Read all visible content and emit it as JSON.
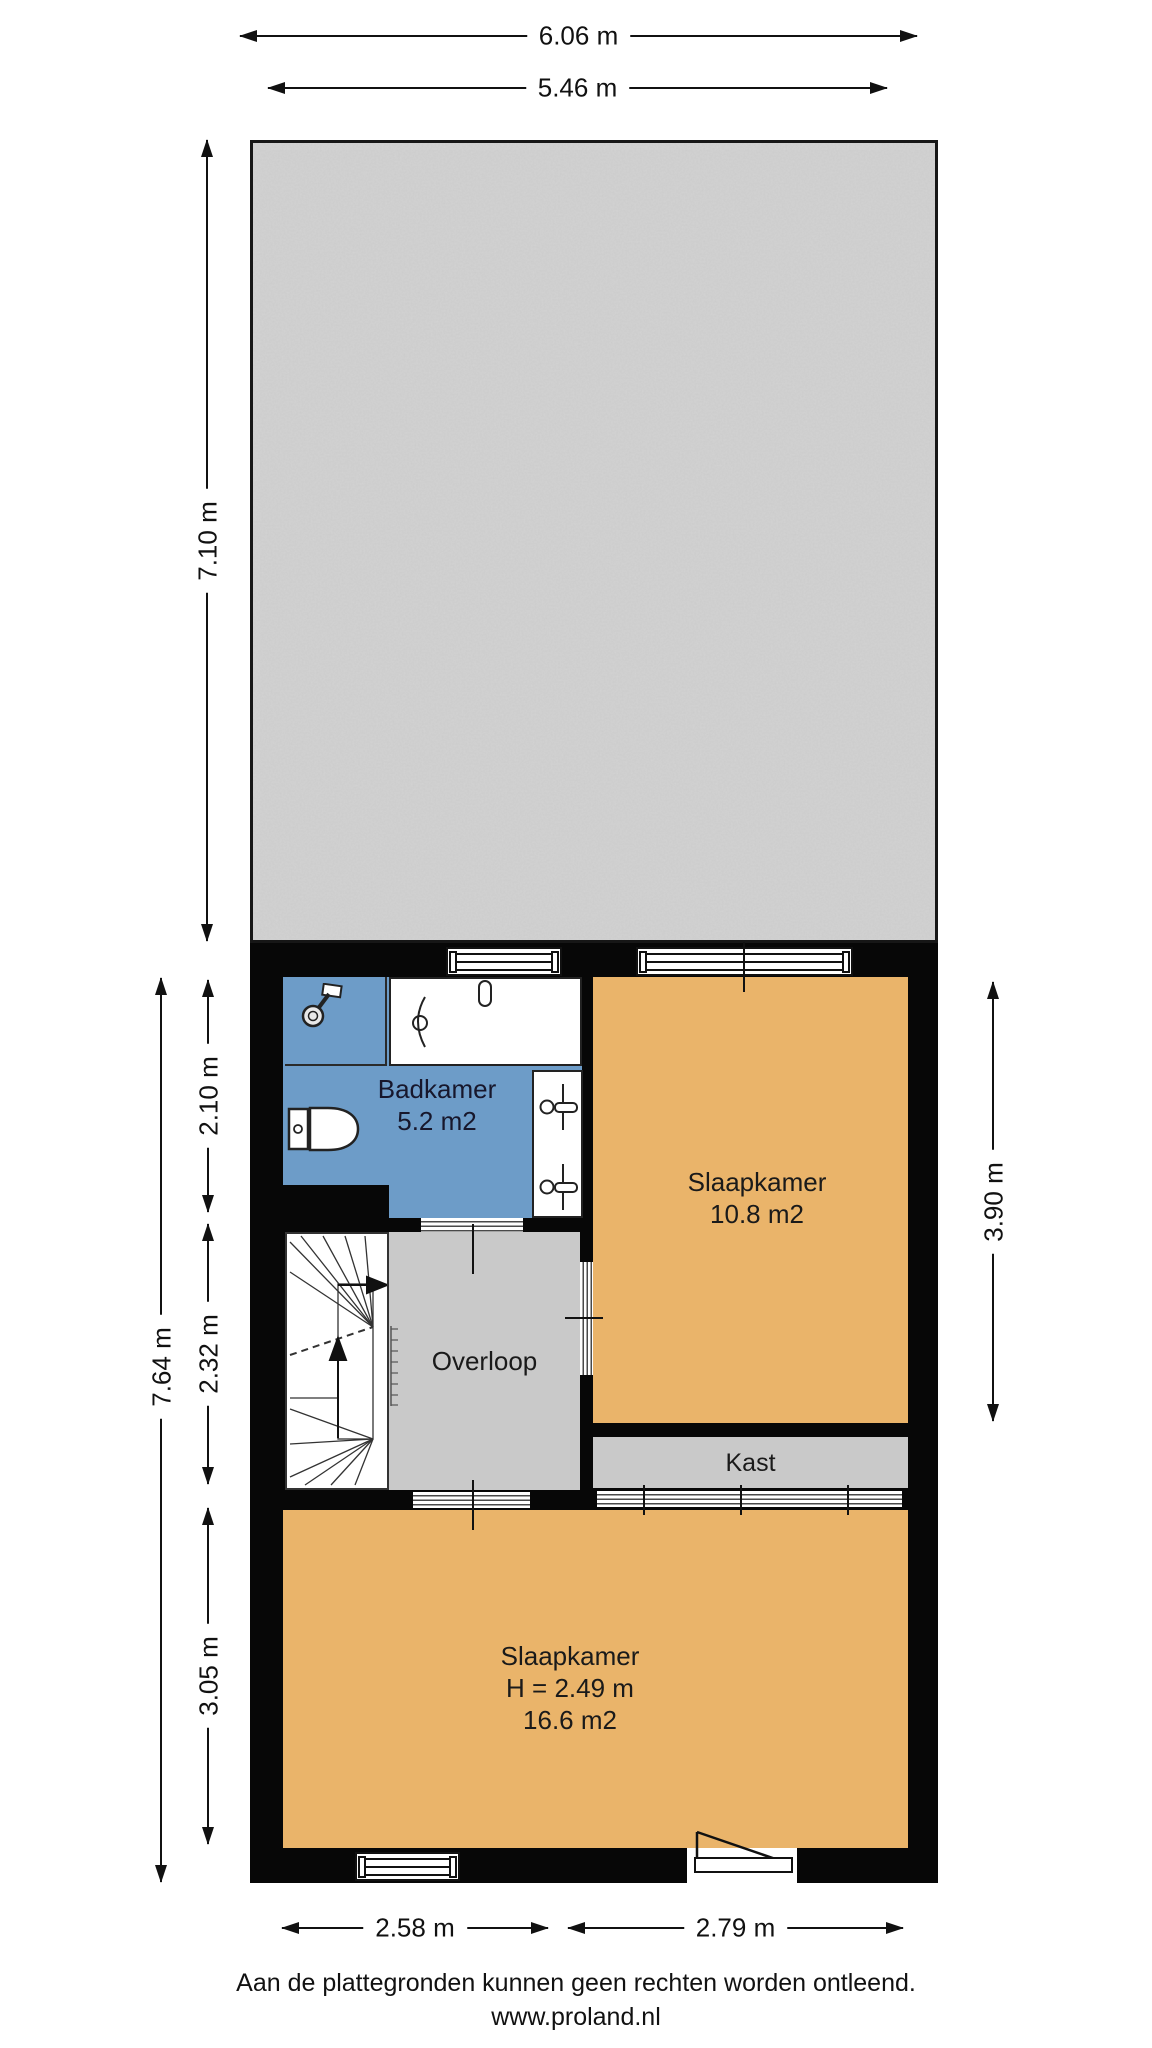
{
  "floorplan": {
    "rooms": {
      "badkamer": {
        "name": "Badkamer",
        "area": "5.2 m2"
      },
      "slaapkamer_klein": {
        "name": "Slaapkamer",
        "area": "10.8 m2"
      },
      "overloop": {
        "name": "Overloop"
      },
      "kast": {
        "name": "Kast"
      },
      "slaapkamer_groot": {
        "name": "Slaapkamer",
        "ceiling_height": "H = 2.49 m",
        "area": "16.6 m2"
      }
    },
    "dimensions": {
      "top_total": "6.06 m",
      "top_inner": "5.46 m",
      "roof_depth": "7.10 m",
      "left_total": "7.64 m",
      "badkamer_depth": "2.10 m",
      "overloop_depth": "2.32 m",
      "slaapkamer_groot_depth": "3.05 m",
      "slaapkamer_klein_depth": "3.90 m",
      "bottom_left_width": "2.58 m",
      "bottom_right_width": "2.79 m"
    },
    "colors": {
      "wall": "#070707",
      "room_orange": "#eab46a",
      "room_blue": "#6d9cc8",
      "room_gray": "#c9c9c9",
      "roof_gray": "#d3d3d3"
    },
    "icons": [
      "shower-icon",
      "bathtub-icon",
      "toilet-icon",
      "faucet-icon",
      "stairs-icon",
      "door-swing-icon",
      "window-icon"
    ]
  },
  "footer": {
    "disclaimer": "Aan de plattegronden kunnen geen rechten worden ontleend.",
    "website": "www.proland.nl"
  }
}
